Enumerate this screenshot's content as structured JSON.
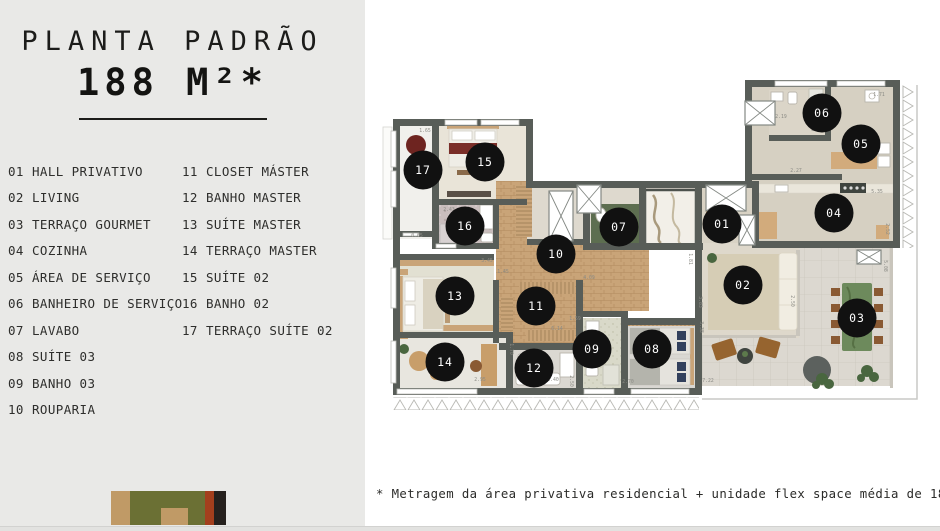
{
  "title": {
    "line1": "PLANTA PADRÃO",
    "line2": "188 M²*"
  },
  "legend": {
    "column1": [
      {
        "num": "01",
        "label": "HALL PRIVATIVO"
      },
      {
        "num": "02",
        "label": "LIVING"
      },
      {
        "num": "03",
        "label": "TERRAÇO GOURMET"
      },
      {
        "num": "04",
        "label": "COZINHA"
      },
      {
        "num": "05",
        "label": "ÁREA DE SERVIÇO"
      },
      {
        "num": "06",
        "label": "BANHEIRO DE SERVIÇO"
      },
      {
        "num": "07",
        "label": "LAVABO"
      },
      {
        "num": "08",
        "label": "SUÍTE 03"
      },
      {
        "num": "09",
        "label": "BANHO 03"
      },
      {
        "num": "10",
        "label": "ROUPARIA"
      }
    ],
    "column2": [
      {
        "num": "11",
        "label": "CLOSET MÁSTER"
      },
      {
        "num": "12",
        "label": "BANHO MASTER"
      },
      {
        "num": "13",
        "label": "SUÍTE MASTER"
      },
      {
        "num": "14",
        "label": "TERRAÇO MASTER"
      },
      {
        "num": "15",
        "label": "SUÍTE 02"
      },
      {
        "num": "16",
        "label": "BANHO 02"
      },
      {
        "num": "17",
        "label": "TERRAÇO SUÍTE 02"
      }
    ]
  },
  "footnote": "* Metragem da área privativa residencial + unidade flex space média de 18m²",
  "floorplan": {
    "wall_color": "#585d58",
    "marker_color": "#111111",
    "markers": [
      {
        "id": "01",
        "x": 343,
        "y": 151
      },
      {
        "id": "02",
        "x": 364,
        "y": 212
      },
      {
        "id": "03",
        "x": 478,
        "y": 245
      },
      {
        "id": "04",
        "x": 455,
        "y": 140
      },
      {
        "id": "05",
        "x": 482,
        "y": 71
      },
      {
        "id": "06",
        "x": 443,
        "y": 40
      },
      {
        "id": "07",
        "x": 240,
        "y": 154
      },
      {
        "id": "08",
        "x": 273,
        "y": 276
      },
      {
        "id": "09",
        "x": 213,
        "y": 276
      },
      {
        "id": "10",
        "x": 177,
        "y": 181
      },
      {
        "id": "11",
        "x": 157,
        "y": 233
      },
      {
        "id": "12",
        "x": 155,
        "y": 295
      },
      {
        "id": "13",
        "x": 76,
        "y": 223
      },
      {
        "id": "14",
        "x": 66,
        "y": 289
      },
      {
        "id": "15",
        "x": 106,
        "y": 89
      },
      {
        "id": "16",
        "x": 86,
        "y": 153
      },
      {
        "id": "17",
        "x": 44,
        "y": 97
      }
    ],
    "dimensions": [
      {
        "t": "1.65",
        "x": 46,
        "y": 59
      },
      {
        "t": "2.43",
        "x": 70,
        "y": 138
      },
      {
        "t": "0.65",
        "x": 38,
        "y": 164
      },
      {
        "t": "3.45",
        "x": 108,
        "y": 189
      },
      {
        "t": "1.45",
        "x": 124,
        "y": 200
      },
      {
        "t": "2.19",
        "x": 402,
        "y": 45
      },
      {
        "t": "2.62",
        "x": 438,
        "y": 58
      },
      {
        "t": "1.71",
        "x": 500,
        "y": 23
      },
      {
        "t": "2.27",
        "x": 417,
        "y": 99
      },
      {
        "t": "5.35",
        "x": 498,
        "y": 120
      },
      {
        "t": "2.52",
        "x": 507,
        "y": 156,
        "r": 90
      },
      {
        "t": "1.81",
        "x": 310,
        "y": 186,
        "r": 90
      },
      {
        "t": "4.09",
        "x": 210,
        "y": 206
      },
      {
        "t": "6.14",
        "x": 178,
        "y": 257
      },
      {
        "t": "1.59",
        "x": 196,
        "y": 247
      },
      {
        "t": "1.70",
        "x": 131,
        "y": 276,
        "r": 90
      },
      {
        "t": "2.40",
        "x": 174,
        "y": 308
      },
      {
        "t": "2.50",
        "x": 191,
        "y": 308,
        "r": 90
      },
      {
        "t": "2.70",
        "x": 249,
        "y": 310
      },
      {
        "t": "7.22",
        "x": 329,
        "y": 309
      },
      {
        "t": "2.95",
        "x": 101,
        "y": 308
      },
      {
        "t": "3.83",
        "x": 320,
        "y": 229,
        "r": 90
      },
      {
        "t": "3.38",
        "x": 321,
        "y": 254,
        "r": 90
      },
      {
        "t": "2.50",
        "x": 412,
        "y": 228,
        "r": 90
      },
      {
        "t": "5.08",
        "x": 505,
        "y": 193,
        "r": 90
      }
    ]
  },
  "logo": {
    "stripes": [
      {
        "name": "tan",
        "color": "#c09a66",
        "width": 19
      },
      {
        "name": "olive",
        "color": "#6b7034",
        "width": 75
      },
      {
        "name": "rust",
        "color": "#a43f1d",
        "width": 9
      },
      {
        "name": "black",
        "color": "#26211e",
        "width": 12
      }
    ],
    "notch_color": "#c09a66"
  }
}
